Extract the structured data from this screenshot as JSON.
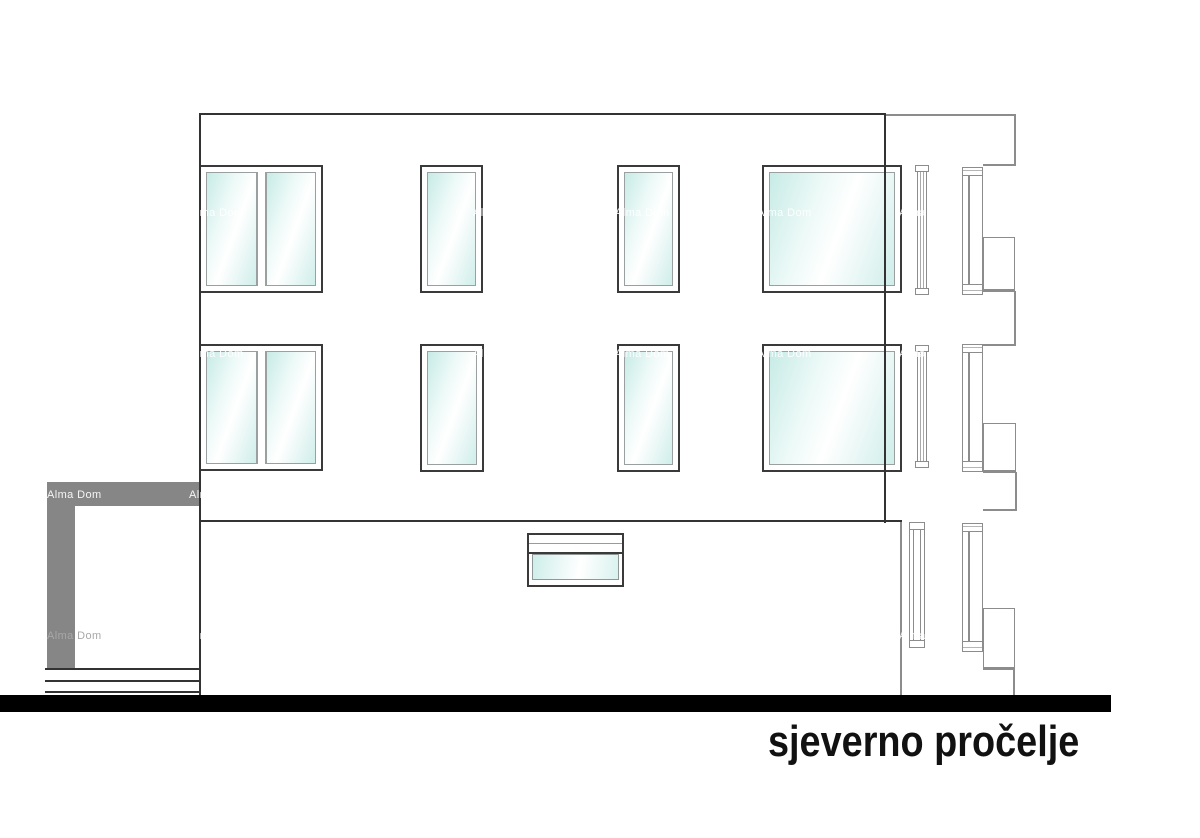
{
  "title": "sjeverno pročelje",
  "watermark": {
    "text": "Alma Dom",
    "cols": [
      47,
      189,
      331,
      473,
      615,
      757,
      899,
      1041
    ],
    "rows": [
      66,
      207,
      348,
      489,
      630
    ],
    "gray_cells": [
      [
        47,
        630
      ]
    ]
  },
  "colors": {
    "line_dark": "#333333",
    "line_gray": "#8c8c8c",
    "terrace_gray": "#868686",
    "ground_black": "#000000",
    "glass_tint": "#c9ebe7"
  },
  "elevation": {
    "dark_lines": [
      {
        "name": "facade-top-edge",
        "x": 199,
        "y": 113,
        "w": 687,
        "h": 2
      },
      {
        "name": "facade-left-edge",
        "x": 199,
        "y": 113,
        "w": 2,
        "h": 584
      },
      {
        "name": "facade-right-edge",
        "x": 884,
        "y": 113,
        "w": 2,
        "h": 410
      },
      {
        "name": "floor-separation-line",
        "x": 199,
        "y": 520,
        "w": 703,
        "h": 2
      }
    ],
    "gray_lines": [
      {
        "name": "roof-extension-line",
        "x": 886,
        "y": 114,
        "w": 129,
        "h": 1.5
      },
      {
        "name": "side-outline",
        "x": 1014,
        "y": 114,
        "w": 1.5,
        "h": 52
      },
      {
        "name": "side-outline",
        "x": 983,
        "y": 164,
        "w": 32,
        "h": 1.5
      },
      {
        "name": "side-outline",
        "x": 1014,
        "y": 291,
        "w": 1.5,
        "h": 55
      },
      {
        "name": "side-outline",
        "x": 983,
        "y": 344,
        "w": 32,
        "h": 1.5
      },
      {
        "name": "side-outline",
        "x": 1015,
        "y": 472,
        "w": 1.5,
        "h": 39
      },
      {
        "name": "side-outline",
        "x": 983,
        "y": 509,
        "w": 33,
        "h": 1.5
      },
      {
        "name": "side-outline",
        "x": 1013,
        "y": 670,
        "w": 1.5,
        "h": 26
      },
      {
        "name": "ground-floor-right-edge",
        "x": 900,
        "y": 522,
        "w": 1.5,
        "h": 174
      }
    ],
    "windows": [
      {
        "kind": "double",
        "x": 199,
        "y": 165,
        "w": 124,
        "h": 128
      },
      {
        "kind": "narrow",
        "x": 420,
        "y": 165,
        "w": 63,
        "h": 128
      },
      {
        "kind": "narrow",
        "x": 617,
        "y": 165,
        "w": 63,
        "h": 128
      },
      {
        "kind": "large",
        "x": 762,
        "y": 165,
        "w": 140,
        "h": 128
      },
      {
        "kind": "double",
        "x": 199,
        "y": 344,
        "w": 124,
        "h": 127
      },
      {
        "kind": "narrow",
        "x": 420,
        "y": 344,
        "w": 64,
        "h": 128
      },
      {
        "kind": "narrow",
        "x": 617,
        "y": 344,
        "w": 63,
        "h": 128
      },
      {
        "kind": "large",
        "x": 762,
        "y": 344,
        "w": 140,
        "h": 128
      }
    ],
    "small_window": {
      "x": 527,
      "y": 533,
      "w": 97,
      "h": 54
    },
    "right_frames": [
      {
        "x": 962,
        "y": 167,
        "w": 21,
        "h": 128
      },
      {
        "x": 962,
        "y": 344,
        "w": 21,
        "h": 128
      },
      {
        "x": 962,
        "y": 523,
        "w": 21,
        "h": 129
      }
    ],
    "right_slims": [
      {
        "x": 915,
        "y": 165,
        "w": 14,
        "h": 130
      },
      {
        "x": 915,
        "y": 345,
        "w": 14,
        "h": 123
      }
    ],
    "right_slim_window": {
      "x": 909,
      "y": 522,
      "w": 16,
      "h": 126
    },
    "right_steps": [
      {
        "x": 983,
        "y": 237,
        "w": 32,
        "h": 55
      },
      {
        "x": 983,
        "y": 423,
        "w": 33,
        "h": 50
      },
      {
        "x": 983,
        "y": 608,
        "w": 32,
        "h": 62
      }
    ],
    "terrace": {
      "bars": [
        {
          "name": "terrace-canopy-bar",
          "x": 47,
          "y": 482,
          "w": 152,
          "h": 24
        },
        {
          "name": "terrace-left-post",
          "x": 47,
          "y": 482,
          "w": 28,
          "h": 188
        }
      ],
      "step_lines": [
        {
          "x": 45,
          "y": 668,
          "w": 155,
          "h": 2
        },
        {
          "x": 45,
          "y": 680,
          "w": 155,
          "h": 2
        },
        {
          "x": 45,
          "y": 691,
          "w": 155,
          "h": 2
        }
      ]
    },
    "ground_bar": {
      "x": 0,
      "y": 695,
      "w": 1111,
      "h": 17
    },
    "title_pos": {
      "x": 768,
      "y": 719
    }
  }
}
